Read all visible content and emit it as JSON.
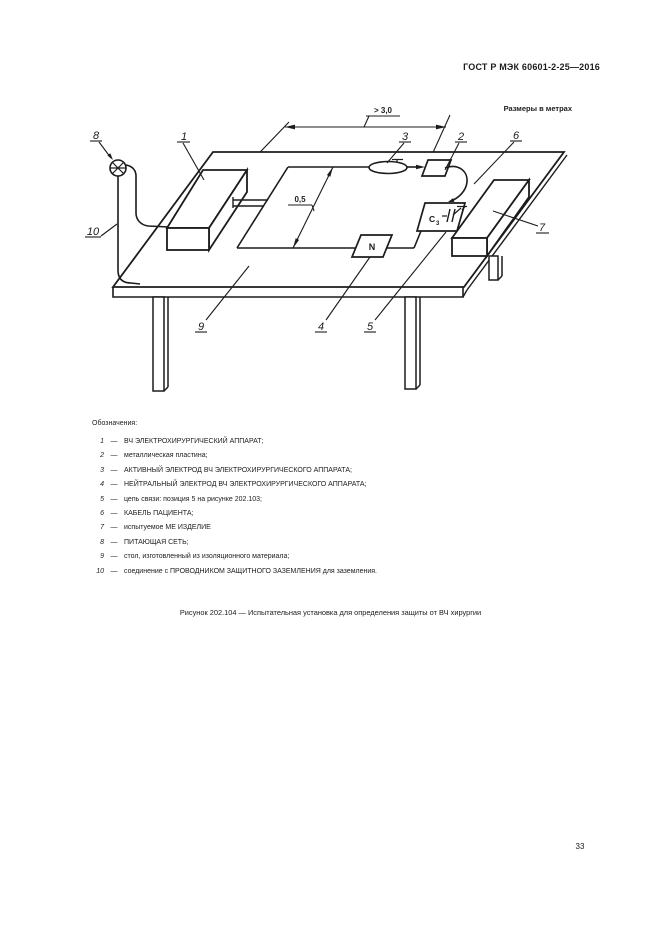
{
  "page": {
    "header": "ГОСТ Р МЭК 60601-2-25—2016",
    "page_number": "33"
  },
  "figure": {
    "units_note": "Размеры в метрах",
    "dim_cable_length": "> 3,0",
    "dim_loop_width": "0,5",
    "neutral_electrode_label": "N",
    "capacitor_label": "C",
    "capacitor_sub": "3",
    "callout_1": "1",
    "callout_2": "2",
    "callout_3": "3",
    "callout_4": "4",
    "callout_5": "5",
    "callout_6": "6",
    "callout_7": "7",
    "callout_8": "8",
    "callout_9": "9",
    "callout_10": "10",
    "caption": "Рисунок 202.104 — Испытательная установка для определения защиты от ВЧ хирургии"
  },
  "legend": {
    "title": "Обозначения:",
    "separator": "—",
    "items": [
      {
        "num": "1",
        "text": "ВЧ ЭЛЕКТРОХИРУРГИЧЕСКИЙ АППАРАТ;"
      },
      {
        "num": "2",
        "text": "металлическая пластина;"
      },
      {
        "num": "3",
        "text": "АКТИВНЫЙ ЭЛЕКТРОД ВЧ ЭЛЕКТРОХИРУРГИЧЕСКОГО АППАРАТА;"
      },
      {
        "num": "4",
        "text": "НЕЙТРАЛЬНЫЙ ЭЛЕКТРОД ВЧ ЭЛЕКТРОХИРУРГИЧЕСКОГО АППАРАТА;"
      },
      {
        "num": "5",
        "text": "цепь связи: позиция 5 на рисунке 202.103;"
      },
      {
        "num": "6",
        "text": "КАБЕЛЬ ПАЦИЕНТА;"
      },
      {
        "num": "7",
        "text": "испытуемое МЕ ИЗДЕЛИЕ"
      },
      {
        "num": "8",
        "text": "ПИТАЮЩАЯ СЕТЬ;"
      },
      {
        "num": "9",
        "text": "стол, изготовленный из изоляционного материала;"
      },
      {
        "num": "10",
        "text": "соединение с ПРОВОДНИКОМ ЗАЩИТНОГО ЗАЗЕМЛЕНИЯ для заземления."
      }
    ]
  }
}
